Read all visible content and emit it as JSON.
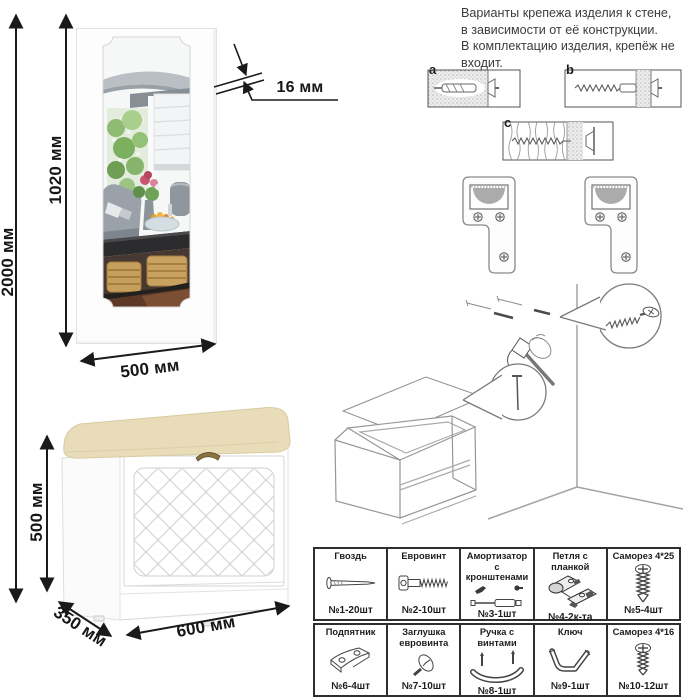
{
  "note": {
    "line1": "Варианты крепежа изделия к стене,",
    "line2": "в зависимости от её конструкции.",
    "line3": "В комплектацию изделия, крепёж не",
    "line4": "входит."
  },
  "wall_mount": {
    "label_a": "a",
    "label_b": "b",
    "label_c": "c"
  },
  "mirror": {
    "dim_total_height": "2000 мм",
    "dim_mirror_height": "1020 мм",
    "dim_thickness": "16 мм",
    "dim_width": "500 мм"
  },
  "bench": {
    "dim_height": "500 мм",
    "dim_depth": "350 мм",
    "dim_width": "600 мм"
  },
  "parts": {
    "row1": [
      {
        "name": "Гвоздь",
        "qty": "№1-20шт"
      },
      {
        "name": "Евровинт",
        "qty": "№2-10шт"
      },
      {
        "name": "Амортизатор с кронштенами",
        "qty": "№3-1шт"
      },
      {
        "name": "Петля с планкой",
        "qty": "№4-2к-та"
      },
      {
        "name": "Саморез 4*25",
        "qty": "№5-4шт"
      }
    ],
    "row2": [
      {
        "name": "Подпятник",
        "qty": "№6-4шт"
      },
      {
        "name": "Заглушка евровинта",
        "qty": "№7-10шт"
      },
      {
        "name": "Ручка с винтами",
        "qty": "№8-1шт"
      },
      {
        "name": "Ключ",
        "qty": "№9-1шт"
      },
      {
        "name": "Саморез 4*16",
        "qty": "№10-12шт"
      }
    ]
  },
  "colors": {
    "cushion_beige": "#e8ddb8",
    "line_dark": "#1a1a1a",
    "table_border": "#2e2e2e"
  }
}
